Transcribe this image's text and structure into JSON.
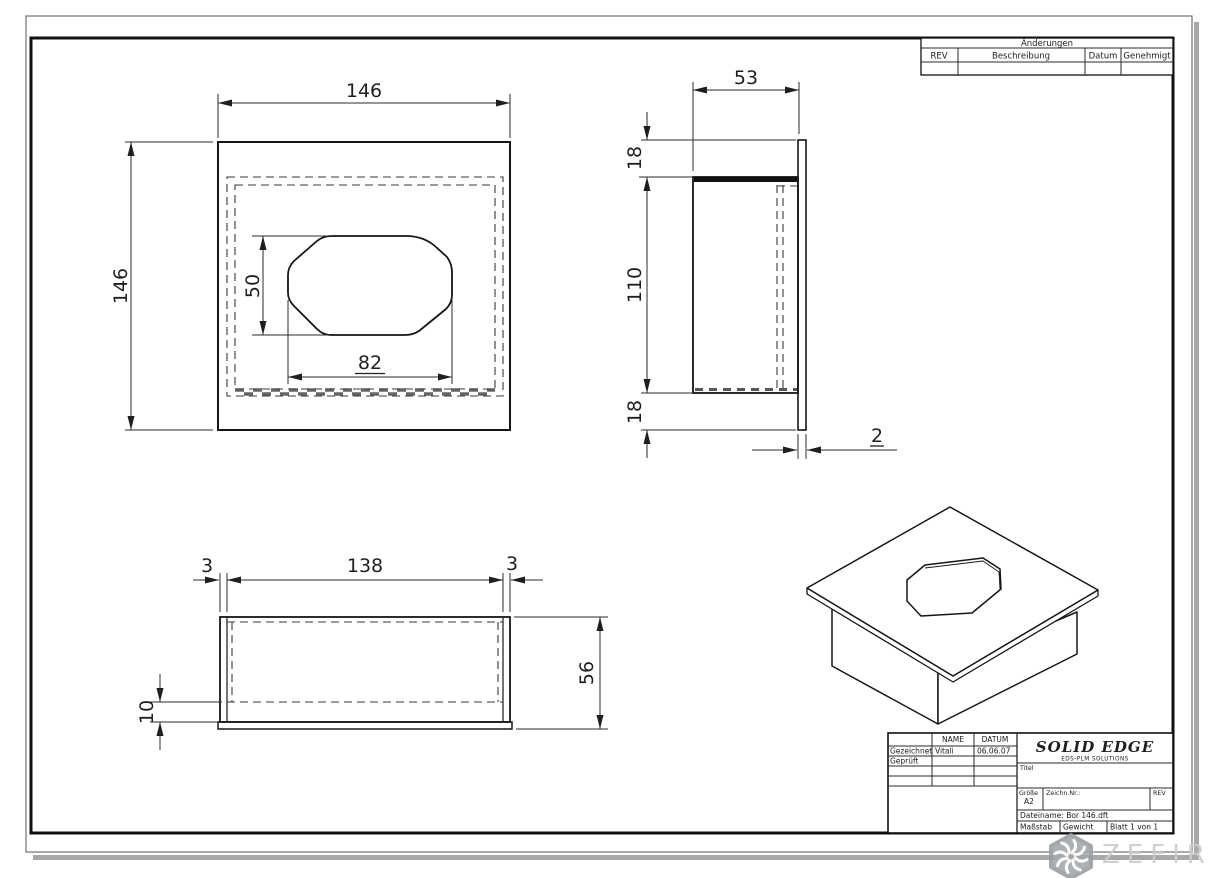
{
  "colors": {
    "line": "#161616",
    "dimension": "#2b2b2b",
    "hatch": "#4a4a4a",
    "shadow": "#a8a8a8",
    "watermark_badge": "#a5a9ab",
    "watermark_text": "#c9cccd"
  },
  "revision_table": {
    "title": "Änderungen",
    "col_rev": "REV",
    "col_beschreibung": "Beschreibung",
    "col_datum": "Datum",
    "col_genehmigt": "Genehmigt"
  },
  "title_block": {
    "col_name": "NAME",
    "col_datum": "DATUM",
    "row1_label": "Gezeichnet",
    "row1_name": "Vitali",
    "row1_datum": "06.06.07",
    "row2_label": "Geprüft",
    "logo": "SOLID EDGE",
    "logo_sub": "EDS-PLM SOLUTIONS",
    "titel_label": "Titel",
    "groesse_label": "Größe",
    "groesse_value": "A2",
    "zeichn_label": "Zeichn.Nr.:",
    "rev_label": "REV",
    "dateiname": "Dateiname: Bor 146.dft",
    "massstab_label": "Maßstab",
    "gewicht_label": "Gewicht",
    "blatt_label": "Blatt 1 von 1"
  },
  "dims": {
    "front": {
      "width": "146",
      "height": "146",
      "hole_height": "50",
      "hole_width": "82"
    },
    "side": {
      "depth": "53",
      "top": "18",
      "height": "110",
      "bottom": "18",
      "thickness": "2"
    },
    "bottom": {
      "wall_left": "3",
      "inner_width": "138",
      "wall_right": "3",
      "height": "56",
      "flange": "10"
    }
  },
  "watermark": {
    "text": "ZEFIRE"
  }
}
